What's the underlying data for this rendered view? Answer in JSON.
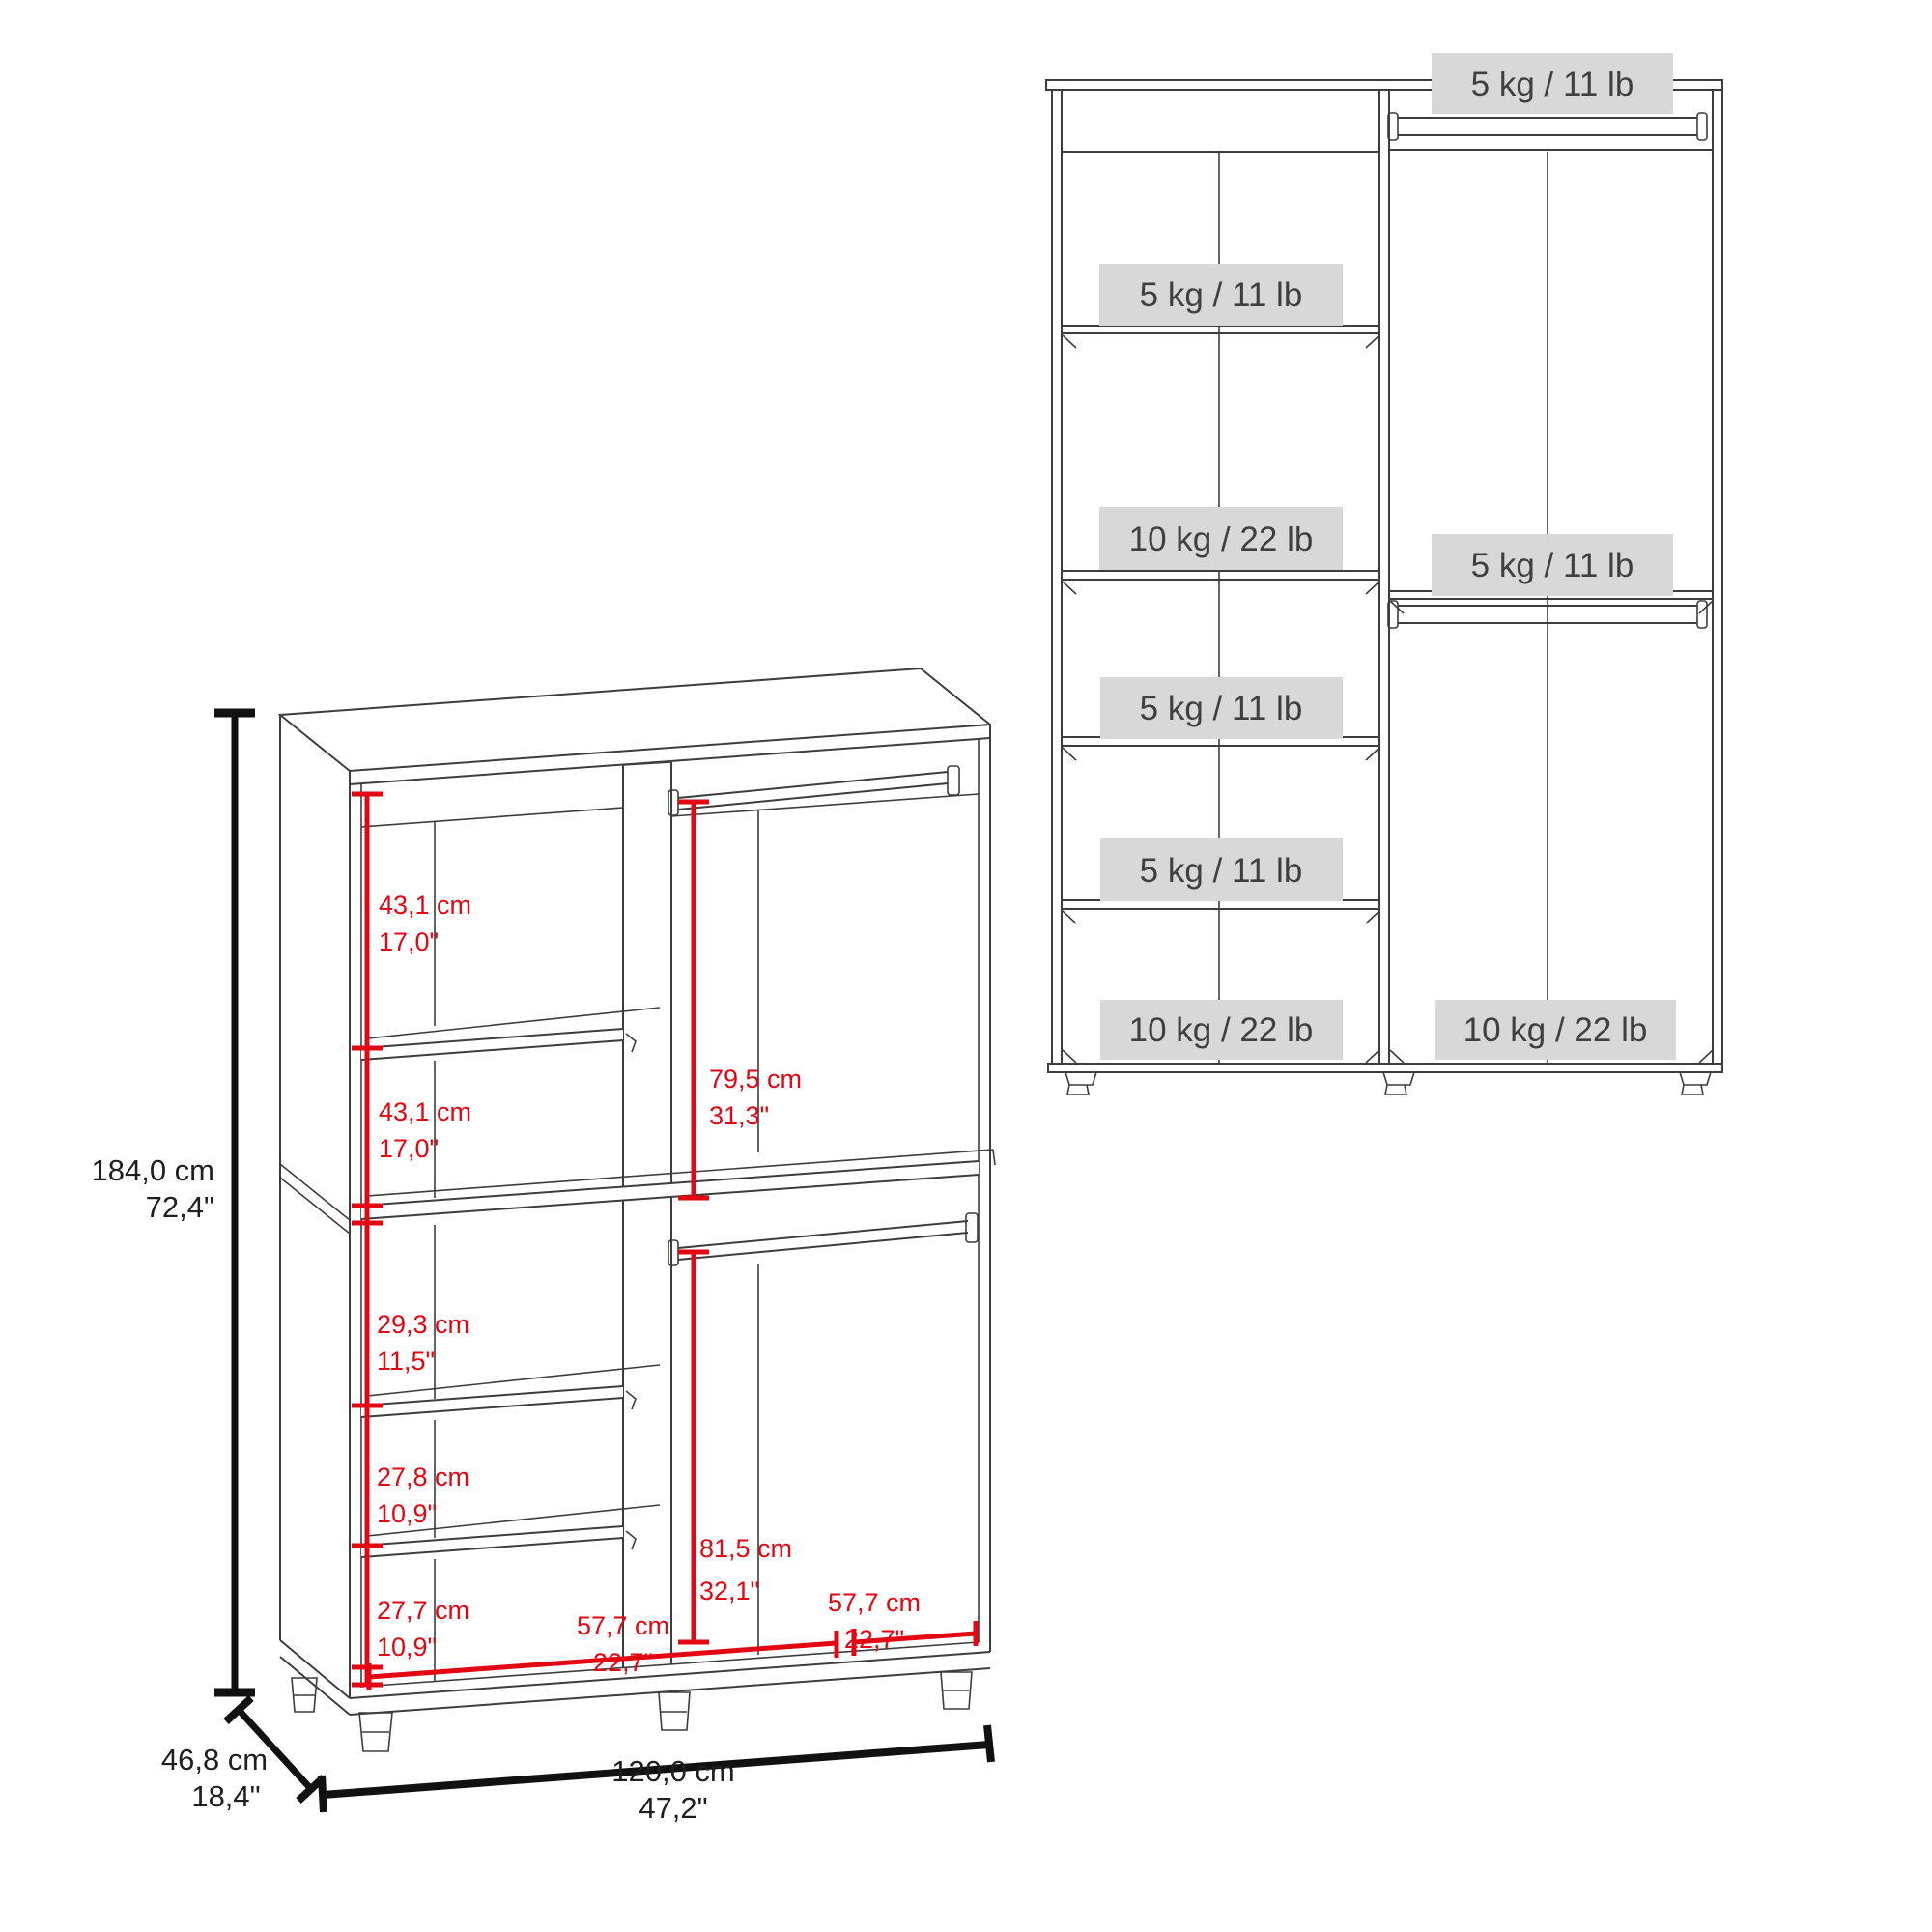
{
  "left_diagram": {
    "height": {
      "cm": "184,0 cm",
      "inch": "72,4\""
    },
    "depth": {
      "cm": "46,8 cm",
      "inch": "18,4\""
    },
    "width": {
      "cm": "120,0 cm",
      "inch": "47,2\""
    },
    "dims": {
      "upper_left_1": {
        "cm": "43,1 cm",
        "inch": "17,0\""
      },
      "upper_left_2": {
        "cm": "43,1 cm",
        "inch": "17,0\""
      },
      "upper_right": {
        "cm": "79,5 cm",
        "inch": "31,3\""
      },
      "lower_left_1": {
        "cm": "29,3 cm",
        "inch": "11,5\""
      },
      "lower_left_2": {
        "cm": "27,8 cm",
        "inch": "10,9\""
      },
      "lower_left_3": {
        "cm": "27,7 cm",
        "inch": "10,9\""
      },
      "lower_left_width": {
        "cm": "57,7 cm",
        "inch": "22,7\""
      },
      "lower_right": {
        "cm": "81,5 cm",
        "inch": "32,1\""
      },
      "lower_right_width": {
        "cm": "57,7 cm",
        "inch": "22,7\""
      }
    }
  },
  "right_diagram": {
    "capacities": {
      "top_rod": "5 kg / 11 lb",
      "left_shelf_1": "5 kg / 11 lb",
      "left_divider": "10 kg / 22 lb",
      "mid_rod": "5 kg / 11 lb",
      "left_shelf_2": "5 kg / 11 lb",
      "left_shelf_3": "5 kg / 11 lb",
      "left_bottom": "10 kg / 22 lb",
      "right_bottom": "10 kg / 22 lb"
    }
  },
  "colors": {
    "dimension_red": "#e30613",
    "line": "#3d3d3d",
    "label_bg": "#d8d8d8",
    "label_text": "#3f3f3f"
  }
}
